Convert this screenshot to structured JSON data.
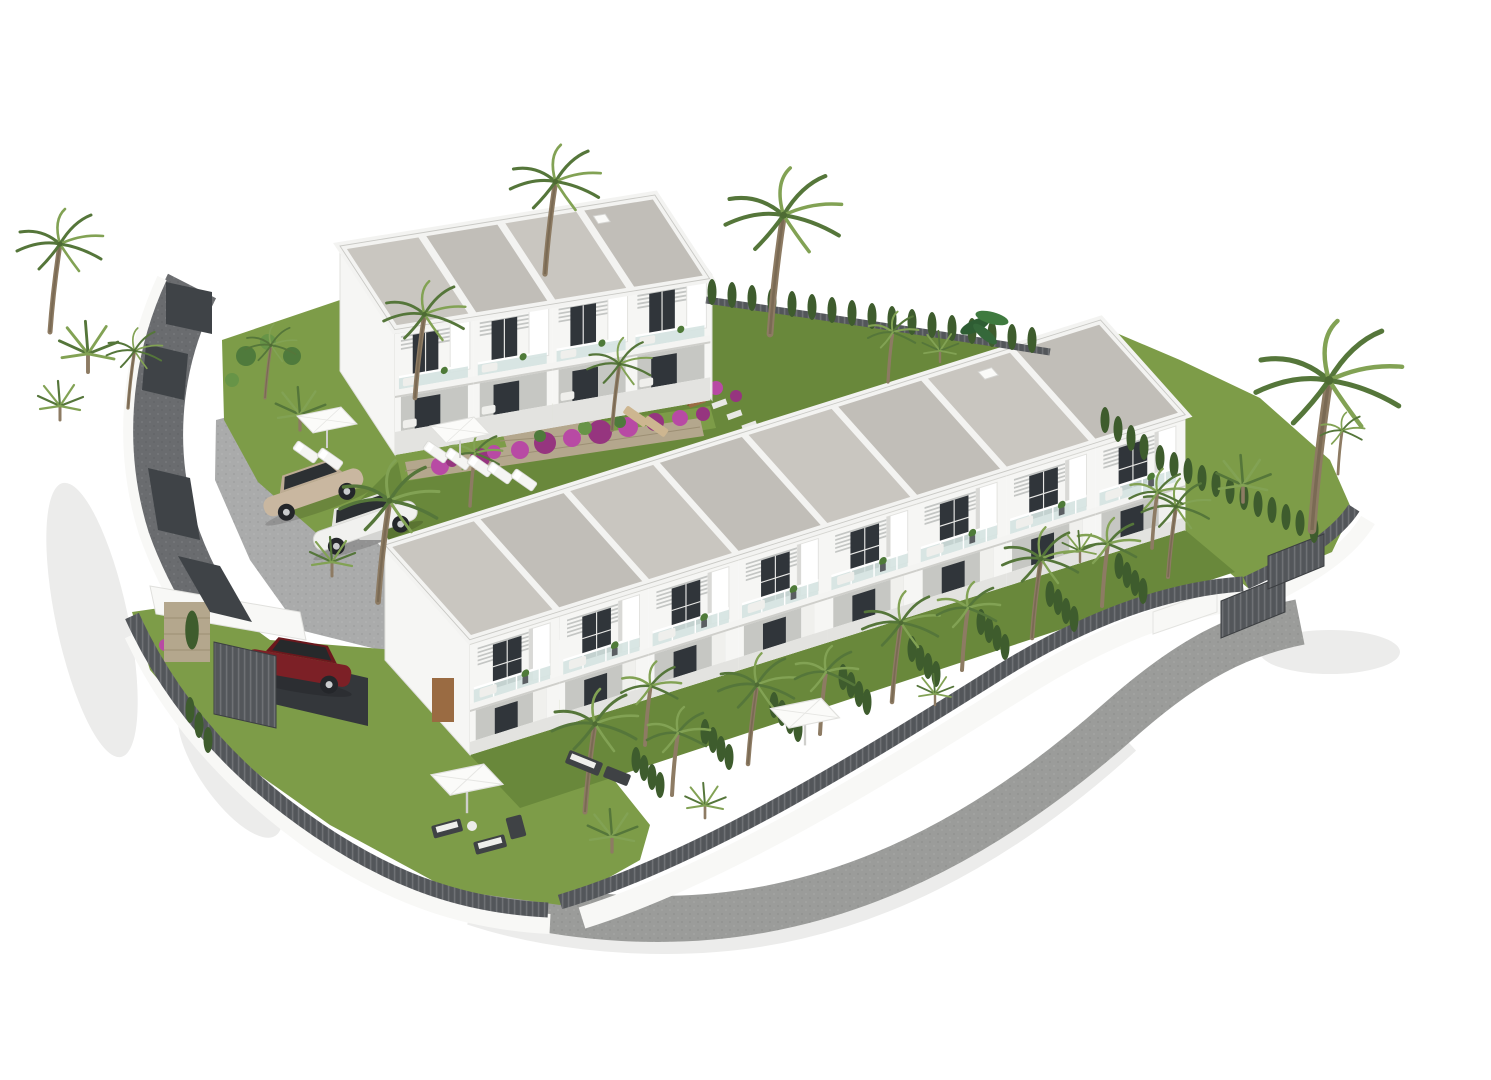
{
  "scene": {
    "type": "3d-architectural-aerial-render",
    "description": "Aerial 3D rendering of a white Mediterranean townhouse development on a white background: a long diagonal row of eight two-storey townhouses with grey gravel flat roofs, glass balconies and pergolas; a second block of four townhouses at the upper left; a turquoise swimming pool with sun loungers and parasols; a paved parking area with a beige and a white sedan; a dark red SUV under a carport; curved grey cobbled perimeter roads; white boundary walls with dark slatted fences and gates; lawns, cypress hedges, bougainvillea and many palm trees including one tall date palm on the right.",
    "objects": [
      {
        "name": "long-townhouse-block",
        "units": 8,
        "storeys": 2
      },
      {
        "name": "upper-townhouse-block",
        "units": 4,
        "storeys": 2
      },
      {
        "name": "swimming-pool",
        "count": 1
      },
      {
        "name": "parasol",
        "count": 4
      },
      {
        "name": "sun-lounger",
        "count": 9
      },
      {
        "name": "car-beige-sedan",
        "count": 1
      },
      {
        "name": "car-white-sedan",
        "count": 1
      },
      {
        "name": "car-red-suv",
        "count": 1
      },
      {
        "name": "carport",
        "count": 1
      },
      {
        "name": "slatted-gate",
        "count": 3
      },
      {
        "name": "tall-date-palm",
        "count": 1
      },
      {
        "name": "palm-tree",
        "count": 30
      },
      {
        "name": "cypress-hedge-row",
        "count": 10
      },
      {
        "name": "bougainvillea-cluster",
        "count": 12
      },
      {
        "name": "outdoor-sofa-set",
        "count": 2
      },
      {
        "name": "perimeter-road",
        "count": 2
      }
    ]
  },
  "palette": {
    "bg": "#ffffff",
    "page_shadow": "#ececeb",
    "road_dark": "#6a6c6f",
    "road_light": "#9b9c9a",
    "parking": "#aaabab",
    "wall_white": "#f8f8f6",
    "facade": "#f6f6f4",
    "roof_gravel": "#c9c6c0",
    "roof_gravel2": "#c1beb8",
    "roof_white": "#f3f3f1",
    "glass": "#30353a",
    "balustrade": "#d5e3e1",
    "recess": "#c6c7c3",
    "slat": "#c4c6c4",
    "grass": "#7d9c48",
    "grass_dark": "#69883b",
    "hedge": "#3e5c2d",
    "palm_dark": "#55763a",
    "palm_light": "#82a254",
    "trunk": "#8d7b63",
    "stone": "#b4a78d",
    "flower": "#b84aa4",
    "flower_dark": "#96357f",
    "pool": "#49b6c9",
    "pool_light": "#8ed6e0",
    "fence": "#53565a",
    "fence_dark": "#3f4347",
    "car_beige": "#c9b7a0",
    "car_white": "#f1f1ef",
    "car_red": "#7c2026",
    "wood": "#9a6b42",
    "furn_dark": "#3f4245",
    "cushion": "#efefec",
    "tan": "#cdb690"
  }
}
